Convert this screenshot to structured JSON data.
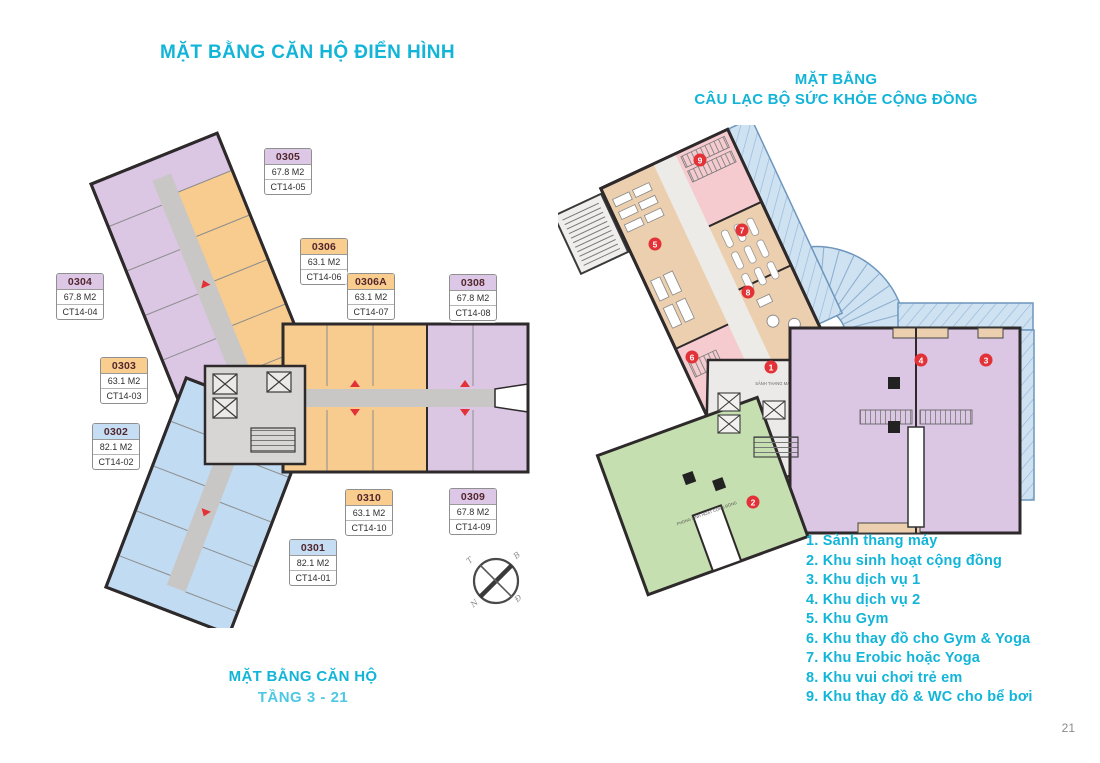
{
  "page": {
    "number": "21"
  },
  "colors": {
    "teal": "#12b5d8",
    "teal_light": "#4ec8e2",
    "purple": "#dbc6e4",
    "orange": "#f7cc8e",
    "blue": "#c0dbf2",
    "pink": "#f6cbd0",
    "tan": "#eccfae",
    "green": "#c6dfb0",
    "pool_blue": "#cfe2f2",
    "corridor_gray": "#c9c7c5",
    "marker_red": "#e23137",
    "label_maroon": "#53262e",
    "wall": "#2e2a2b"
  },
  "left_plan": {
    "title": "MẶT BẰNG CĂN HỘ ĐIỂN HÌNH",
    "caption_title": "MẶT BẰNG CĂN HỘ",
    "caption_subtitle": "TẦNG 3 - 21",
    "units": [
      {
        "id": "0305",
        "area": "67.8 M2",
        "code": "CT14-05",
        "color": "#dcc8e6",
        "x": 264,
        "y": 148
      },
      {
        "id": "0304",
        "area": "67.8 M2",
        "code": "CT14-04",
        "color": "#dcc8e6",
        "x": 56,
        "y": 273
      },
      {
        "id": "0306",
        "area": "63.1 M2",
        "code": "CT14-06",
        "color": "#f9cd8e",
        "x": 300,
        "y": 238
      },
      {
        "id": "0306A",
        "area": "63.1 M2",
        "code": "CT14-07",
        "color": "#f9cd8e",
        "x": 347,
        "y": 273
      },
      {
        "id": "0308",
        "area": "67.8 M2",
        "code": "CT14-08",
        "color": "#dcc8e6",
        "x": 449,
        "y": 274
      },
      {
        "id": "0303",
        "area": "63.1 M2",
        "code": "CT14-03",
        "color": "#f9cd8e",
        "x": 100,
        "y": 357
      },
      {
        "id": "0302",
        "area": "82.1 M2",
        "code": "CT14-02",
        "color": "#c5def3",
        "x": 92,
        "y": 423
      },
      {
        "id": "0310",
        "area": "63.1 M2",
        "code": "CT14-10",
        "color": "#f9cd8e",
        "x": 345,
        "y": 489
      },
      {
        "id": "0309",
        "area": "67.8 M2",
        "code": "CT14-09",
        "color": "#dcc8e6",
        "x": 449,
        "y": 488
      },
      {
        "id": "0301",
        "area": "82.1 M2",
        "code": "CT14-01",
        "color": "#c5def3",
        "x": 289,
        "y": 539
      }
    ],
    "compass_letters": [
      "T",
      "B",
      "N",
      "Đ"
    ]
  },
  "right_plan": {
    "title_line1": "MẶT BẰNG",
    "title_line2": "CÂU LẠC BỘ SỨC KHỎE CỘNG ĐỒNG",
    "area_labels": {
      "lobby": "SẢNH THANG MÁY",
      "community": "PHÒNG SINH HOẠT CỘNG ĐỒNG"
    },
    "legend": [
      {
        "num": "1",
        "label": "Sảnh thang máy"
      },
      {
        "num": "2",
        "label": "Khu sinh hoạt cộng đồng"
      },
      {
        "num": "3",
        "label": "Khu dịch vụ 1"
      },
      {
        "num": "4",
        "label": "Khu dịch vụ 2"
      },
      {
        "num": "5",
        "label": "Khu Gym"
      },
      {
        "num": "6",
        "label": "Khu thay đồ cho Gym & Yoga"
      },
      {
        "num": "7",
        "label": "Khu Erobic hoặc Yoga"
      },
      {
        "num": "8",
        "label": "Khu vui chơi trẻ em"
      },
      {
        "num": "9",
        "label": "Khu thay đồ & WC cho bể bơi"
      }
    ],
    "markers": [
      {
        "num": "9",
        "x": 700,
        "y": 160
      },
      {
        "num": "5",
        "x": 655,
        "y": 244
      },
      {
        "num": "7",
        "x": 742,
        "y": 230
      },
      {
        "num": "8",
        "x": 748,
        "y": 292
      },
      {
        "num": "6",
        "x": 692,
        "y": 357
      },
      {
        "num": "1",
        "x": 771,
        "y": 367
      },
      {
        "num": "4",
        "x": 921,
        "y": 360
      },
      {
        "num": "3",
        "x": 986,
        "y": 360
      },
      {
        "num": "2",
        "x": 753,
        "y": 502
      }
    ]
  }
}
